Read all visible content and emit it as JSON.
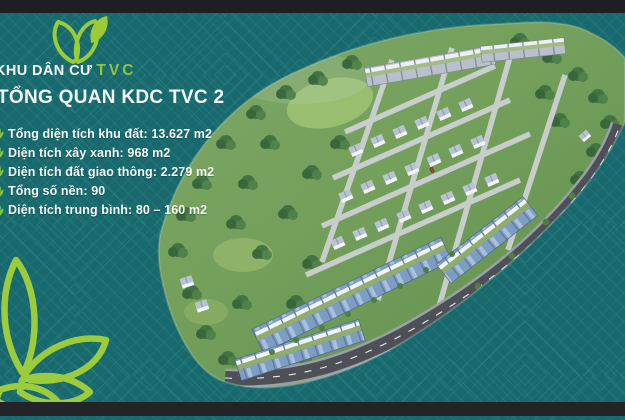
{
  "brand": {
    "name_prefix": "KHU DÂN CƯ",
    "name_accent": "TVC"
  },
  "heading": {
    "title": "TỔNG QUAN KDC TVC 2"
  },
  "stats": {
    "items": [
      {
        "text": "Tổng diện tích khu đất: 13.627 m2"
      },
      {
        "text": "Diện tích xây xanh: 968 m2"
      },
      {
        "text": "Diện tích đất giao thông: 2.279 m2"
      },
      {
        "text": "Tổng số nền: 90"
      },
      {
        "text": "Diện tích trung bình: 80 – 160 m2"
      }
    ]
  },
  "icons": {
    "logo": "twin-leaves-icon",
    "stat_bullet": "leaf-sprout-icon",
    "decoration": "lotus-leaves-outline-icon"
  },
  "colors": {
    "background_teal": "#18696D",
    "pattern_line": "#3A9A94",
    "accent_green": "#8DC63F",
    "lime_outline": "#9CCB3B",
    "text_white": "#F4F7F4",
    "letterbox_bar": "#1E1F23"
  }
}
